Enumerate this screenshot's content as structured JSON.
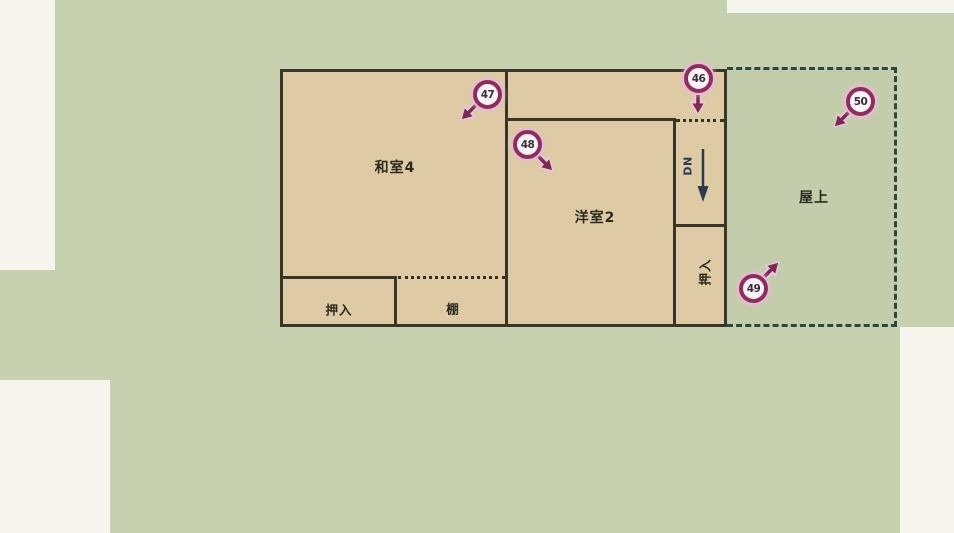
{
  "diagram_type": "floor-plan",
  "rooms": {
    "washitsu4": "和室4",
    "yoshitsu2": "洋室2",
    "oshiire_left": "押入",
    "tana": "棚",
    "oshiire_right": "押入",
    "okujo": "屋上"
  },
  "stairs": {
    "label": "DN",
    "direction": "down"
  },
  "markers": [
    {
      "number": "46",
      "arrow": "down"
    },
    {
      "number": "47",
      "arrow": "down-left"
    },
    {
      "number": "48",
      "arrow": "down-right"
    },
    {
      "number": "49",
      "arrow": "up-right"
    },
    {
      "number": "50",
      "arrow": "down-left"
    }
  ],
  "colors": {
    "page_white": "#f5f5ee",
    "site_green": "#c7d0af",
    "room_tan": "#decaa5",
    "wall": "#3a3526",
    "rooftop_dash": "#2a4742",
    "stair_arrow": "#2c3a4e",
    "marker_ring": "#8d2f5c",
    "marker_fill": "#fcf2f7",
    "marker_arrow": "#7b2a53"
  }
}
